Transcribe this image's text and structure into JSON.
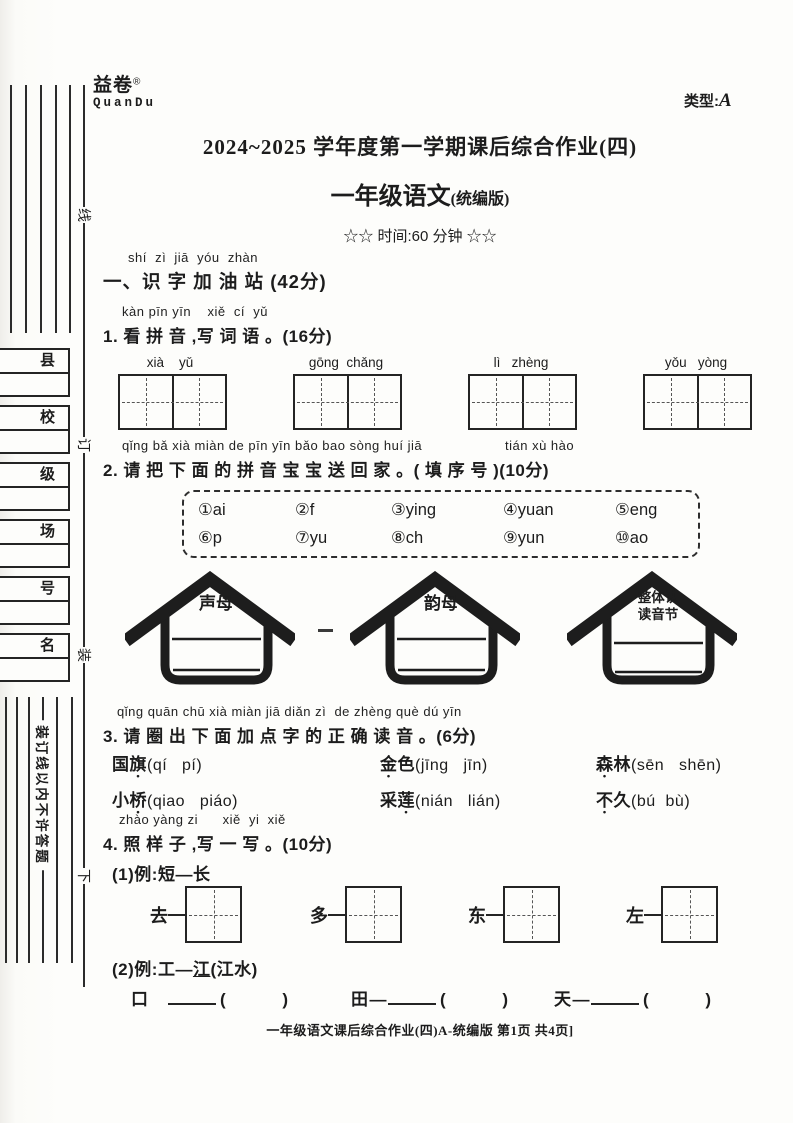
{
  "page": {
    "brand": {
      "logo_cn": "益卷",
      "reg_mark": "®",
      "logo_en": "QuanDu"
    },
    "type_label": "类型:",
    "type_value": "A",
    "title": "2024~2025 学年度第一学期课后综合作业(四)",
    "subtitle_main": "一年级语文",
    "subtitle_edition": "(统编版)",
    "time_line": "☆☆  时间:60 分钟  ☆☆",
    "footer": "一年级语文课后综合作业(四)A-统编版   第1页   共4页]"
  },
  "margin": {
    "binding_chars": [
      "线",
      "订",
      "装"
    ],
    "below_char": "下",
    "no_answer_text": "装订线以内不许答题",
    "field_boxes": [
      "县",
      "校",
      "级",
      "场",
      "号",
      "名"
    ]
  },
  "section1": {
    "pinyin": "shí  zì  jiā  yóu  zhàn",
    "heading": "一、识 字 加 油 站 (42分)"
  },
  "q1": {
    "pinyin": "kàn pīn yīn    xiě  cí  yǔ",
    "text": "1. 看 拼 音 ,写 词 语 。(16分)",
    "words": [
      {
        "pinyin": "xià    yǔ"
      },
      {
        "pinyin": "gōng  chǎng"
      },
      {
        "pinyin": "lì   zhèng"
      },
      {
        "pinyin": "yǒu   yòng"
      }
    ]
  },
  "q2": {
    "pinyin_main": "qǐng bǎ xià miàn de pīn yīn bǎo bao sòng huí jiā",
    "pinyin_tail": "tián xù hào",
    "text": "2. 请 把 下 面 的 拼 音 宝 宝 送 回 家 。( 填 序 号 )(10分)",
    "options_row1": [
      "①ai",
      "②f",
      "③ying",
      "④yuan",
      "⑤eng"
    ],
    "options_row2": [
      "⑥p",
      "⑦yu",
      "⑧ch",
      "⑨yun",
      "⑩ao"
    ],
    "houses": [
      {
        "label": "声母"
      },
      {
        "label": "韵母"
      },
      {
        "label_line1": "整体认",
        "label_line2": "读音节"
      }
    ]
  },
  "q3": {
    "pinyin": "qǐng quān chū xià miàn jiā diǎn zì  de zhèng què dú yīn",
    "text": "3. 请 圈 出 下 面 加 点 字 的 正 确 读 音 。(6分)",
    "items": [
      {
        "before": "国",
        "dotted": "旗",
        "after": "",
        "pron": "(qí   pí)"
      },
      {
        "before": "",
        "dotted": "金",
        "after": "色",
        "pron": "(jīng   jīn)"
      },
      {
        "before": "",
        "dotted": "森",
        "after": "林",
        "pron": "(sēn   shēn)"
      },
      {
        "before": "小",
        "dotted": "桥",
        "after": "",
        "pron": "(qiao   piáo)"
      },
      {
        "before": "采",
        "dotted": "莲",
        "after": "",
        "pron": "(nián   lián)"
      },
      {
        "before": "",
        "dotted": "不",
        "after": "久",
        "pron": "(bú  bù)"
      }
    ]
  },
  "q4": {
    "pinyin": "zhào yàng zi      xiě  yi  xiě",
    "text": "4. 照 样 子 ,写 一 写 。(10分)",
    "part1_label": "(1)例:短—长",
    "part1_items": [
      "去",
      "多",
      "东",
      "左"
    ],
    "part2_label_pre": "(2)例:工—",
    "part2_label_underlined": "江",
    "part2_label_post": "(江水)",
    "part2_items": [
      {
        "char": "口",
        "dash": "",
        "paren": "(            )"
      },
      {
        "char": "田",
        "dash": "—",
        "paren": "(            )"
      },
      {
        "char": "天",
        "dash": "—",
        "paren": "(            )"
      }
    ]
  }
}
